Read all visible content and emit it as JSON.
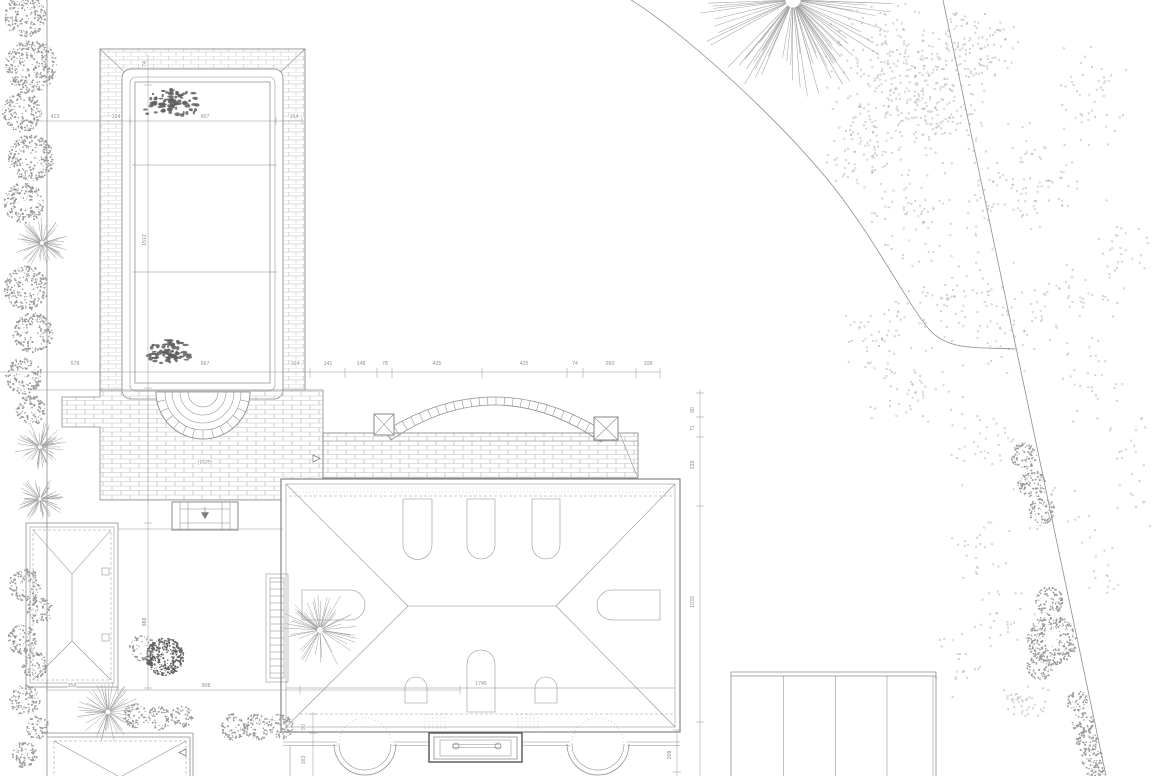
{
  "drawing": {
    "kind": "landscape-site-plan"
  },
  "colors": {
    "line": "#8d8d8d",
    "brick": "#b9b9b9",
    "text": "#8f8f8f",
    "bold": "#5f5f5f",
    "stipple": "#9a9a9a",
    "dark_plant": "#5e5e5e",
    "background": "#ffffff"
  },
  "dims": {
    "d413": "413",
    "d164a": "164",
    "d607": "607",
    "d164b": "164",
    "d74a": "74",
    "d1512": "1512",
    "d578": "578",
    "d667": "667",
    "d164c": "164",
    "d141": "141",
    "d148": "148",
    "d78": "78",
    "d425a": "425",
    "d425b": "425",
    "d74b": "74",
    "d260": "260",
    "d108": "108",
    "d1625": "(1625)",
    "d988": "988",
    "d358": "358",
    "d908": "908",
    "d1745": "1745",
    "d90a": "90",
    "d71": "71",
    "d339": "339",
    "d1033": "1033",
    "d208": "208",
    "d90b": "90",
    "d163": "163"
  }
}
